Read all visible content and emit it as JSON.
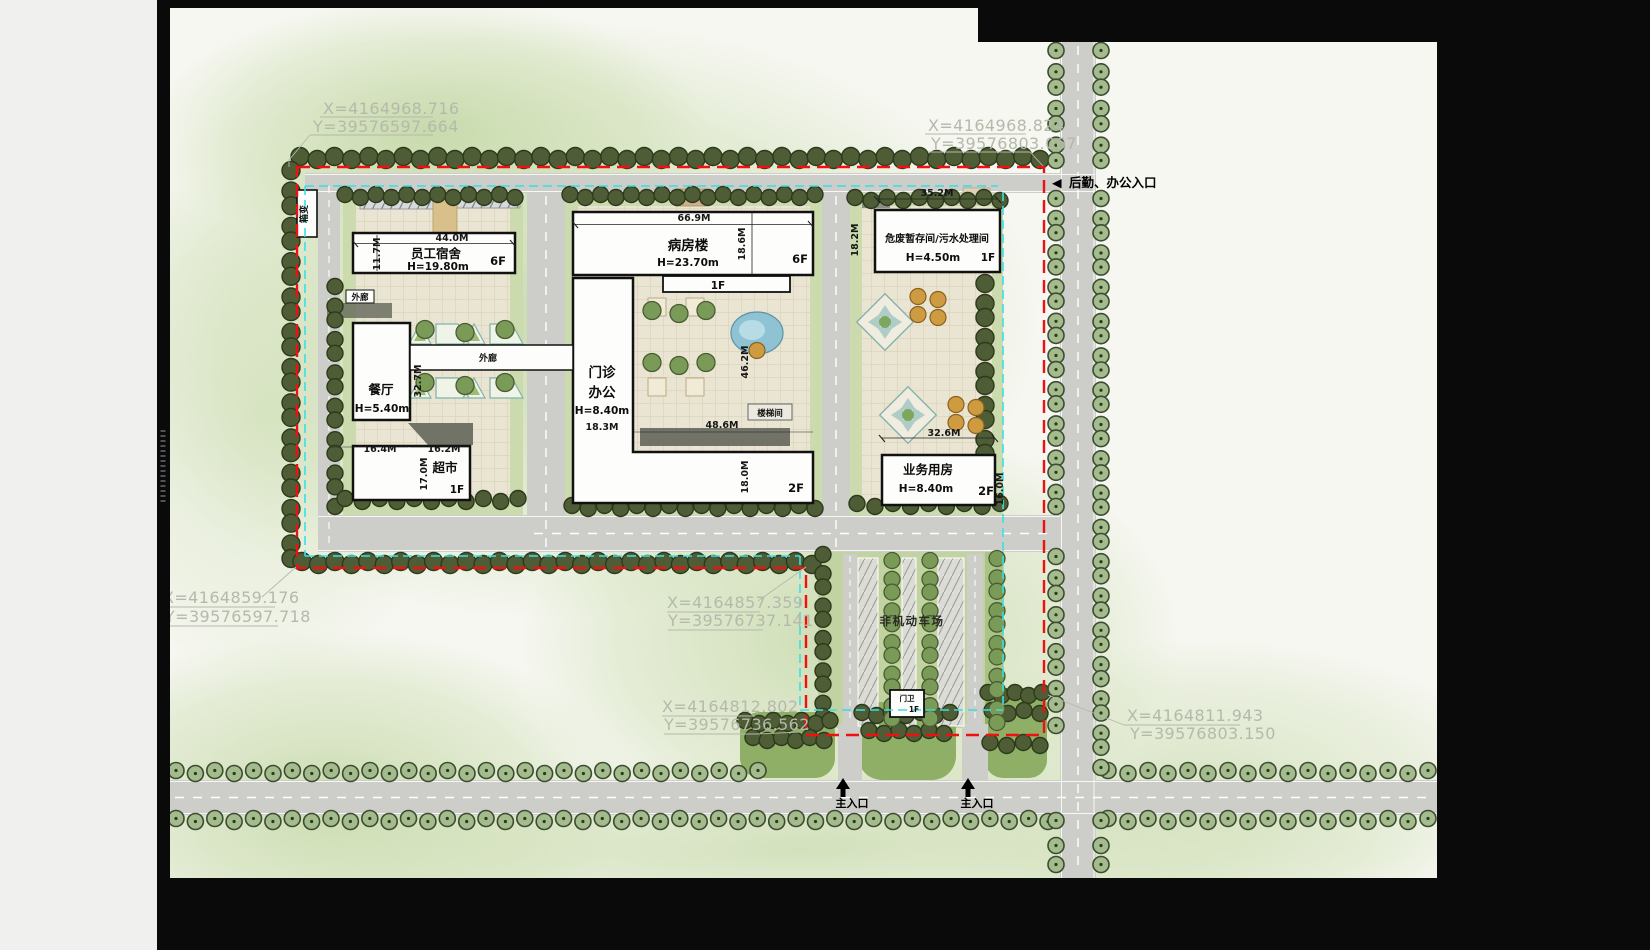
{
  "plan": {
    "coord_callouts": [
      {
        "x_label": "X=4164968.716",
        "y_label": "Y=39576597.664"
      },
      {
        "x_label": "X=4164968.824",
        "y_label": "Y=39576803.067"
      },
      {
        "x_label": "X=4164859.176",
        "y_label": "Y=39576597.718"
      },
      {
        "x_label": "X=4164857.359",
        "y_label": "Y=39576737.141"
      },
      {
        "x_label": "X=4164812.802",
        "y_label": "Y=39576736.562"
      },
      {
        "x_label": "X=4164811.943",
        "y_label": "Y=39576803.150"
      }
    ],
    "entrances": {
      "service_arrow": "◀",
      "service_label": "后勤、办公入口",
      "main_label": "主入口"
    },
    "buildings": {
      "dorm": {
        "name": "员工宿舍",
        "height": "H=19.80m",
        "floors": "6F"
      },
      "ward": {
        "name": "病房楼",
        "height": "H=23.70m",
        "floors": "6F",
        "podium_floors": "1F"
      },
      "hazmat": {
        "name": "危废暂存间/污水处理间",
        "height": "H=4.50m",
        "floors": "1F"
      },
      "canteen": {
        "name": "餐厅",
        "height": "H=5.40m"
      },
      "market": {
        "name": "超市",
        "floors": "1F"
      },
      "clinic": {
        "line1": "门诊",
        "line2": "办公",
        "height": "H=8.40m",
        "floors": "2F"
      },
      "business": {
        "name": "业务用房",
        "height": "H=8.40m",
        "floors": "2F"
      },
      "gatehouse": {
        "name": "门卫",
        "floors": "1F"
      }
    },
    "annotations": {
      "transformer": "箱变",
      "corridor": "外廊",
      "stairwell": "楼梯间",
      "bike_parking": "非机动车场"
    },
    "dimensions": {
      "dorm_w": "44.0M",
      "dorm_d": "11.7M",
      "ward_w": "66.9M",
      "ward_d": "18.6M",
      "hazmat_w": "35.2M",
      "hazmat_d": "18.2M",
      "canteen_d": "32.7M",
      "market_w1": "16.4M",
      "market_w2": "16.2M",
      "market_d": "17.0M",
      "clinic_w": "18.3M",
      "court_d": "46.2M",
      "court_w": "48.6M",
      "clinic_s": "18.0M",
      "business_w": "32.6M",
      "business_d": "16.0M"
    },
    "colors": {
      "boundary_red": "#ee1111",
      "setback_cyan": "#3adfe6",
      "road_gray": "#cdcdc9",
      "paper": "#f6f7f1",
      "tree_dark": "#4e5d35",
      "tree_street": "#a3bb8d",
      "paving": "#eae5d2"
    }
  }
}
